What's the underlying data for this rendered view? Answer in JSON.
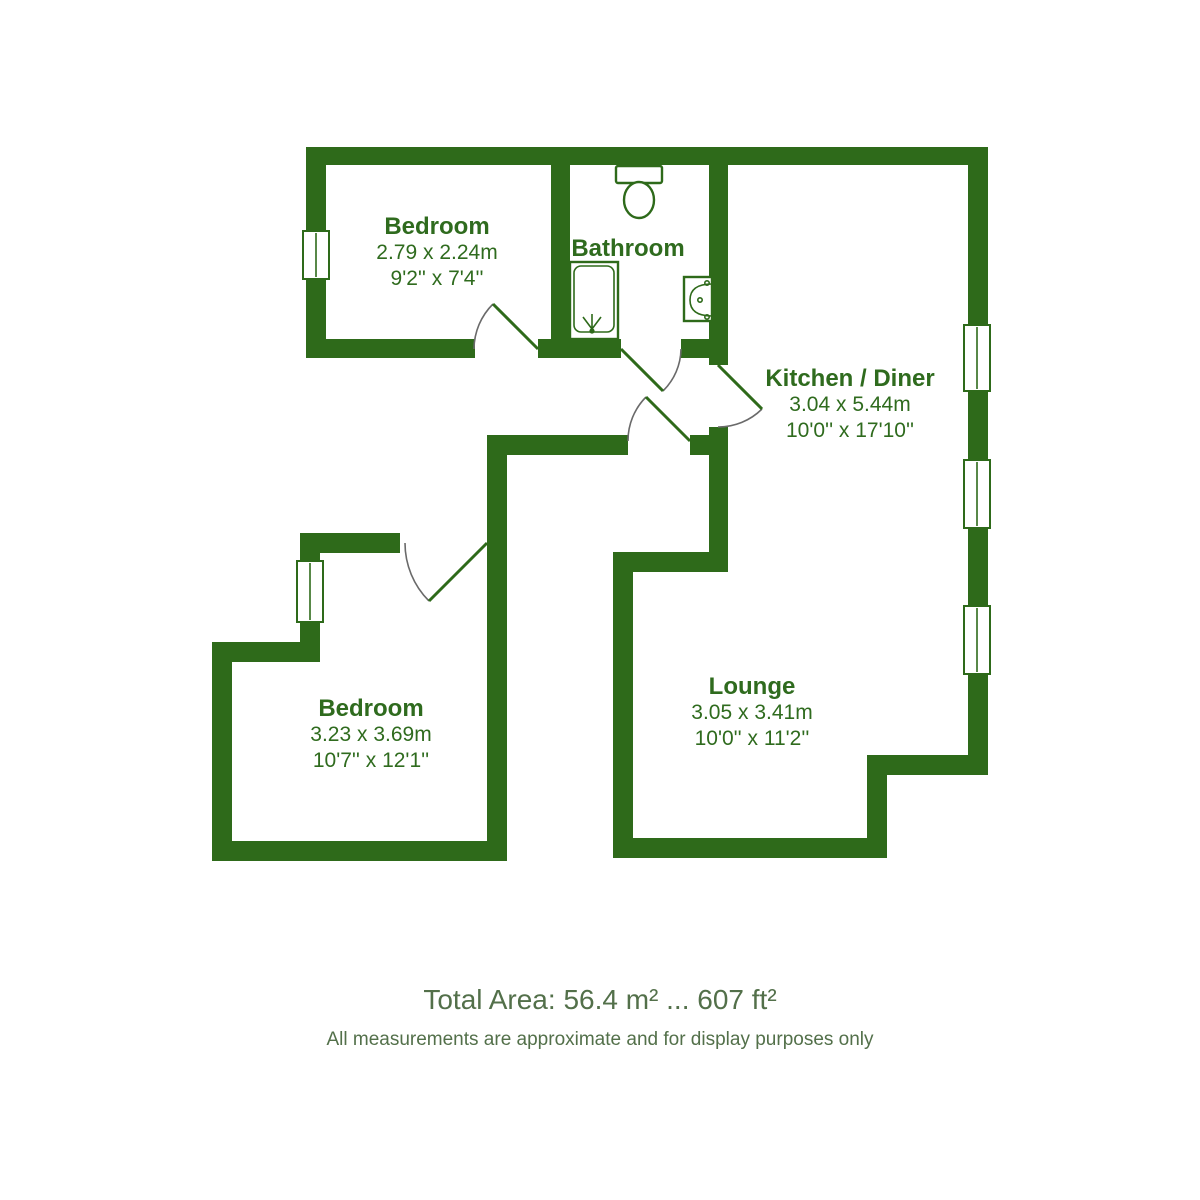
{
  "palette": {
    "wall_green": "#2e6a1a",
    "label_green": "#2f6b1e",
    "footer_green": "#53704a"
  },
  "rooms": [
    {
      "id": "bedroom-1",
      "name": "Bedroom",
      "metric": "2.79 x 2.24m",
      "imperial": "9'2'' x 7'4''"
    },
    {
      "id": "bathroom",
      "name": "Bathroom",
      "metric": "",
      "imperial": ""
    },
    {
      "id": "kitchen-diner",
      "name": "Kitchen / Diner",
      "metric": "3.04 x 5.44m",
      "imperial": "10'0'' x 17'10''"
    },
    {
      "id": "lounge",
      "name": "Lounge",
      "metric": "3.05 x 3.41m",
      "imperial": "10'0'' x 11'2''"
    },
    {
      "id": "bedroom-2",
      "name": "Bedroom",
      "metric": "3.23 x 3.69m",
      "imperial": "10'7'' x 12'1''"
    }
  ],
  "fixtures": [
    "toilet-icon",
    "shower-icon",
    "sink-icon"
  ],
  "openings": {
    "windows": 5,
    "doors": [
      "bedroom-1-door",
      "bathroom-door",
      "kitchen-door",
      "entrance-door",
      "bedroom-2-door"
    ]
  },
  "footer": {
    "total_area": "Total Area: 56.4 m² ... 607 ft²",
    "disclaimer": "All measurements are approximate and for display purposes only"
  }
}
